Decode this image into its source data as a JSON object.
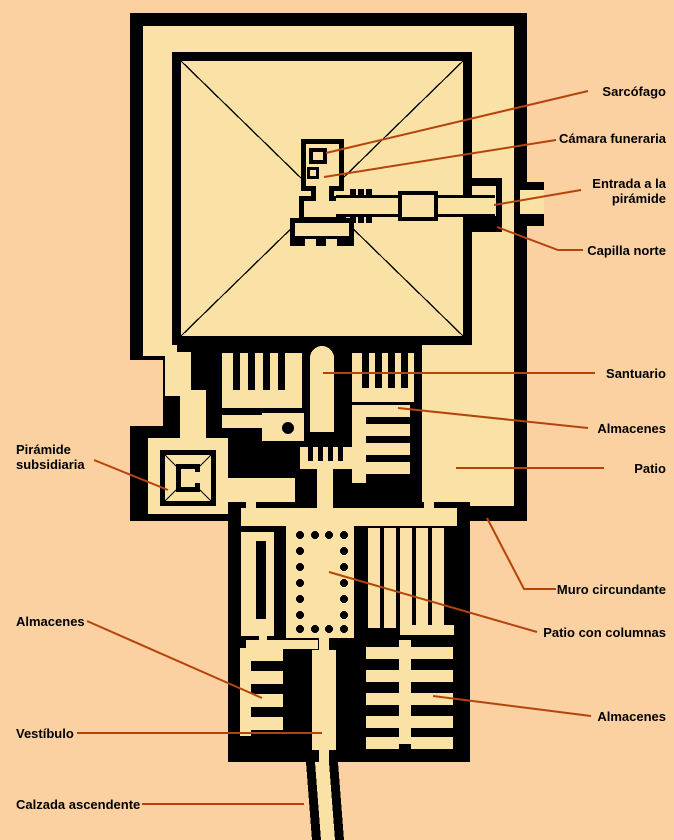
{
  "colors": {
    "background": "#fbd1a1",
    "plan_fill": "#fae1a6",
    "wall": "#000000",
    "leader_line": "#b5430c",
    "label_text": "#000000"
  },
  "labels": {
    "sarcofago": "Sarcófago",
    "camara_funeraria": "Cámara funeraria",
    "entrada_piramide": "Entrada a la pirámide",
    "capilla_norte": "Capilla norte",
    "santuario": "Santuario",
    "almacenes_este": "Almacenes",
    "patio": "Patio",
    "muro_circundante": "Muro circundante",
    "patio_columnas": "Patio con columnas",
    "almacenes_sureste": "Almacenes",
    "piramide_subsidiaria": "Pirámide subsidiaria",
    "almacenes_oeste": "Almacenes",
    "vestibulo": "Vestíbulo",
    "calzada_ascendente": "Calzada ascendente"
  }
}
